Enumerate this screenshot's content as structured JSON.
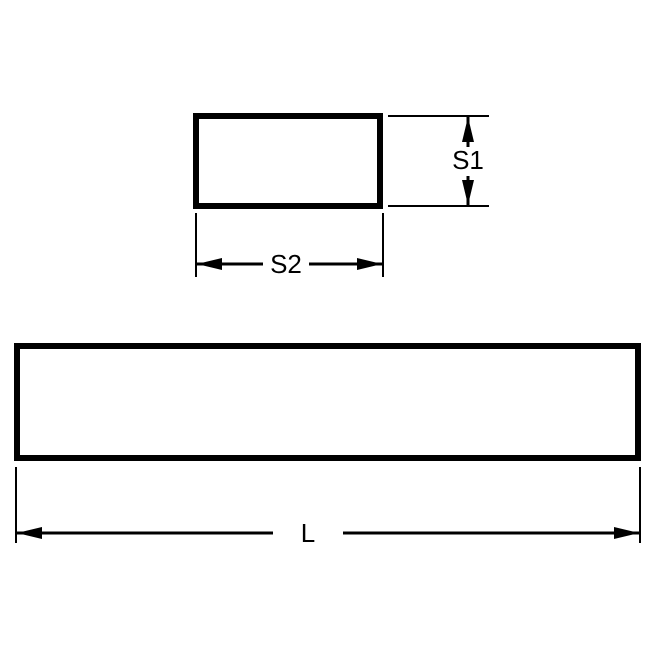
{
  "diagram": {
    "colors": {
      "line": "#000000",
      "background": "#ffffff"
    },
    "cross_section_view": {
      "height_label": "S1",
      "width_label": "S2"
    },
    "side_view": {
      "length_label": "L"
    }
  }
}
